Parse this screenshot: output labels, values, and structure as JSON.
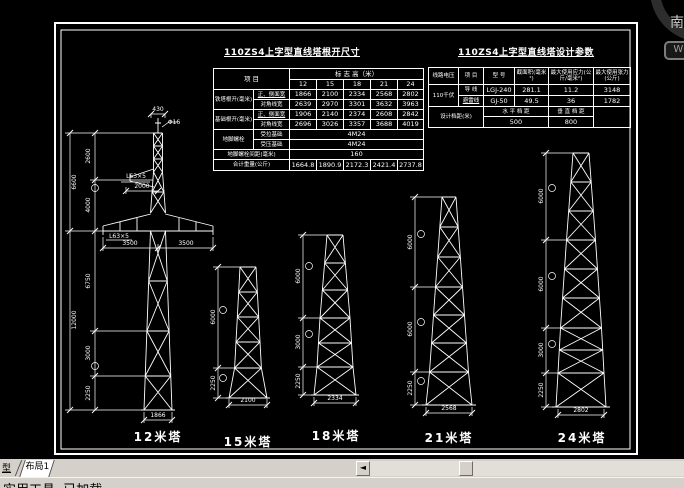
{
  "viewcube": {
    "south": "南",
    "wcs": "WCS"
  },
  "left_table": {
    "title": "110ZS4上字型直线塔根开尺寸",
    "item_header": "项  目",
    "height_header": "标 志 高（米）",
    "cols": [
      "12",
      "15",
      "18",
      "21",
      "24"
    ],
    "tower_root_label": "铁塔根开(毫米)",
    "front_side_label": "正、侧面宽",
    "diagonal_label": "对角线宽",
    "tower_root_front": [
      "1866",
      "2100",
      "2334",
      "2568",
      "2802"
    ],
    "tower_root_diag": [
      "2639",
      "2970",
      "3301",
      "3632",
      "3963"
    ],
    "foundation_root_label": "基础根开(毫米)",
    "foundation_front": [
      "1906",
      "2140",
      "2374",
      "2608",
      "2842"
    ],
    "foundation_diag": [
      "2696",
      "3026",
      "3357",
      "3688",
      "4019"
    ],
    "anchor_bolt_label": "地脚螺栓",
    "tension_label": "受拉基础",
    "tension_value": "4M24",
    "compression_label": "受压基础",
    "compression_value": "4M24",
    "spacing_label": "地脚螺栓间距(毫米)",
    "spacing_value": "160",
    "weight_label": "合计重量(公斤)",
    "weights": [
      "1664.8",
      "1890.9",
      "2172.3",
      "2421.4",
      "2737.8"
    ]
  },
  "right_table": {
    "title": "110ZS4上字型直线塔设计参数",
    "h_voltage": "线路电压",
    "h_item": "项 目",
    "h_model": "型 号",
    "h_section": "截面积(毫米²)",
    "h_stress": "最大使用应力(公斤/毫米²)",
    "h_tension": "最大使用张力(公斤)",
    "voltage": "110千伏",
    "conductor_label": "导 线",
    "conductor_model": "LGJ-240",
    "conductor_section": "281.1",
    "conductor_stress": "11.2",
    "conductor_tension": "3148",
    "groundwire_label": "避雷线",
    "groundwire_model": "GJ-50",
    "groundwire_section": "49.5",
    "groundwire_stress": "36",
    "groundwire_tension": "1782",
    "span_label": "设计档距(米)",
    "h_span_label": "水 平 档 距",
    "h_span_value": "500",
    "v_span_label": "垂 直 档 距",
    "v_span_value": "800"
  },
  "towers": {
    "t12": {
      "name": "12米塔",
      "top_width": "430",
      "rod_dia": "Φ16",
      "gw_arm_label": "L63×5",
      "gw_arm_dim": "2000",
      "arm_label": "L63×5",
      "arm_left": "3500",
      "arm_right": "3500",
      "upper_total": "6600",
      "upper_segs": [
        "2600",
        "4000"
      ],
      "lower_total": "12000",
      "lower_segs": [
        "6750",
        "3000",
        "2250"
      ],
      "base_width": "1866"
    },
    "t15": {
      "name": "15米塔",
      "segs": [
        "6000",
        "2250"
      ],
      "base_width": "2100"
    },
    "t18": {
      "name": "18米塔",
      "segs": [
        "6000",
        "3000",
        "2250"
      ],
      "base_width": "2334"
    },
    "t21": {
      "name": "21米塔",
      "segs": [
        "6000",
        "6000",
        "2250"
      ],
      "base_width": "2568"
    },
    "t24": {
      "name": "24米塔",
      "segs": [
        "6000",
        "6000",
        "3000",
        "2250"
      ],
      "base_width": "2802"
    }
  },
  "tabbar": {
    "model_tab": "型",
    "layout_tab": "布局1",
    "scroll_left_arrow": "◄"
  },
  "statusbar": {
    "message": "实用工具. 已加载"
  }
}
